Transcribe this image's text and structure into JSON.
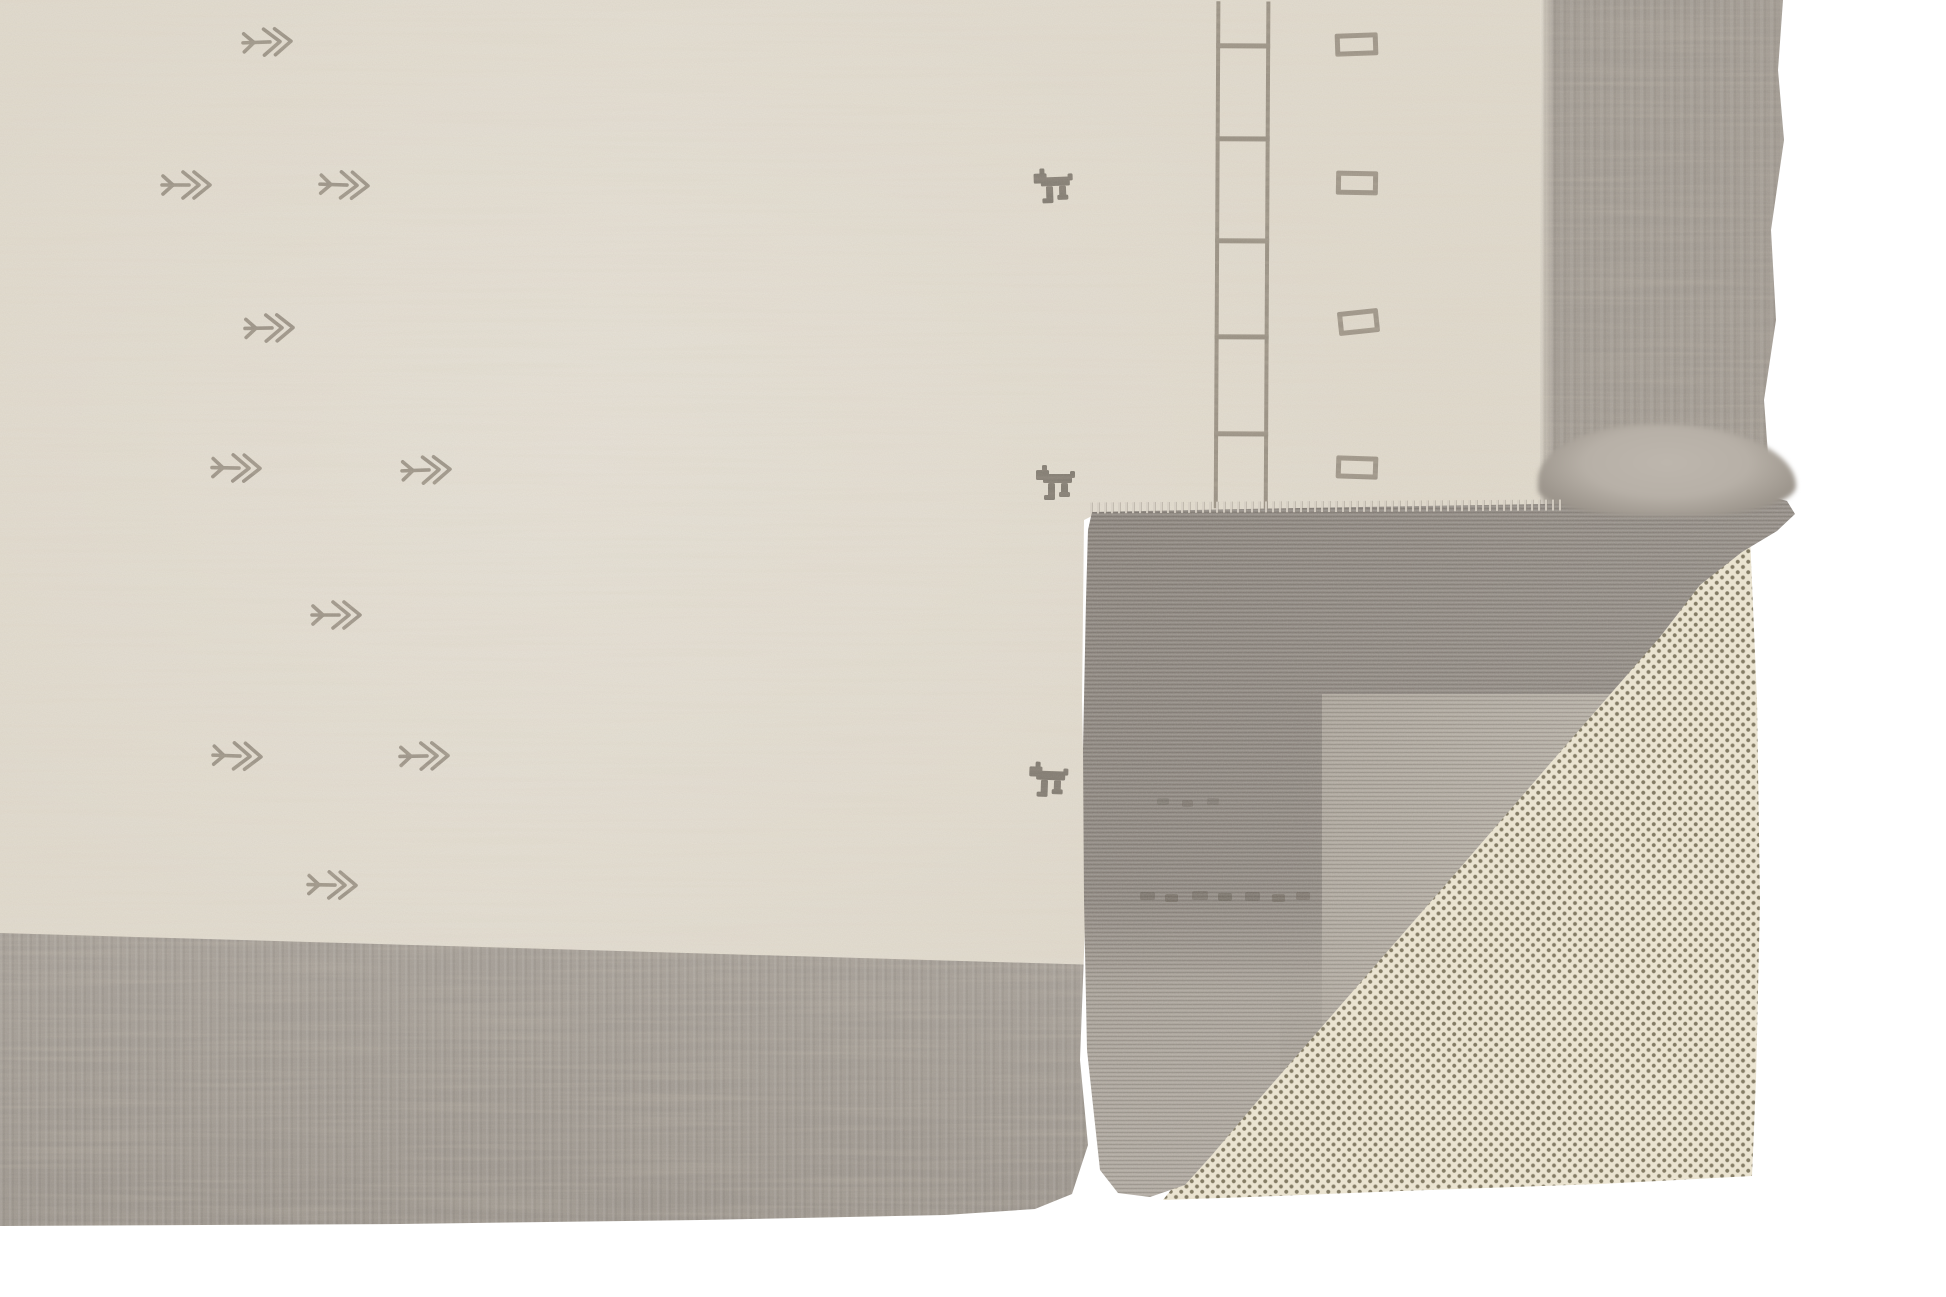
{
  "scene": {
    "description": "Product photograph of a hand-loomed wool area rug shown on a white background. The rug has an ivory field with sparse woven tribal motifs and a mottled gray border along its bottom and right sides. The bottom-right corner is folded over, revealing the gray ribbed back of the rug resting on a cream non-slip rug pad perforated with a grid of small dots.",
    "background": "plain white"
  },
  "colors": {
    "bg": "#ffffff",
    "field": "#e2dcd0",
    "borderFront": "#a29b93",
    "backDark": "#8c857e",
    "backMid": "#a39c93",
    "backLight": "#b6aea3",
    "pad": "#ece5d2",
    "padDot": "#837b64",
    "motif": "#857c6f",
    "motifDark": "#574f44",
    "animal": "#6b645b",
    "roll": "#b7b0a7",
    "fringe": "#d6cfc4"
  },
  "motifs": {
    "arrows": [
      {
        "x": 268,
        "y": 42,
        "rot": -2
      },
      {
        "x": 187,
        "y": 185,
        "rot": 0
      },
      {
        "x": 345,
        "y": 185,
        "rot": 2
      },
      {
        "x": 270,
        "y": 328,
        "rot": -1
      },
      {
        "x": 237,
        "y": 468,
        "rot": 1
      },
      {
        "x": 427,
        "y": 470,
        "rot": -2
      },
      {
        "x": 337,
        "y": 615,
        "rot": 0
      },
      {
        "x": 238,
        "y": 756,
        "rot": 2
      },
      {
        "x": 425,
        "y": 756,
        "rot": -1
      },
      {
        "x": 333,
        "y": 885,
        "rot": 1
      }
    ],
    "animals": [
      {
        "x": 1055,
        "y": 188,
        "rot": -2
      },
      {
        "x": 1057,
        "y": 485,
        "rot": 0
      },
      {
        "x": 1050,
        "y": 782,
        "rot": 2
      }
    ],
    "ladder": {
      "rails_x": [
        1213,
        1263
      ],
      "rail_width": 4,
      "y_top": 0,
      "y_bottom": 507,
      "rung_ys": [
        42,
        135,
        237,
        333,
        430
      ],
      "rung_height": 5,
      "tilt_deg": 0.3
    },
    "rectangles": [
      {
        "x": 1335,
        "y": 33,
        "w": 43,
        "h": 23,
        "rot": -2
      },
      {
        "x": 1336,
        "y": 171,
        "w": 42,
        "h": 24,
        "rot": 1
      },
      {
        "x": 1338,
        "y": 310,
        "w": 41,
        "h": 24,
        "rot": -6
      },
      {
        "x": 1336,
        "y": 456,
        "w": 42,
        "h": 23,
        "rot": 2
      }
    ],
    "back_marks": [
      {
        "x": 1140,
        "y": 892,
        "w": 15,
        "h": 8,
        "opacity": 0.3
      },
      {
        "x": 1165,
        "y": 894,
        "w": 13,
        "h": 8,
        "opacity": 0.34
      },
      {
        "x": 1192,
        "y": 891,
        "w": 16,
        "h": 9,
        "opacity": 0.28
      },
      {
        "x": 1218,
        "y": 893,
        "w": 14,
        "h": 8,
        "opacity": 0.36
      },
      {
        "x": 1245,
        "y": 892,
        "w": 15,
        "h": 9,
        "opacity": 0.3
      },
      {
        "x": 1272,
        "y": 894,
        "w": 13,
        "h": 8,
        "opacity": 0.33
      },
      {
        "x": 1296,
        "y": 892,
        "w": 14,
        "h": 8,
        "opacity": 0.27
      },
      {
        "x": 1157,
        "y": 798,
        "w": 12,
        "h": 7,
        "opacity": 0.2
      },
      {
        "x": 1182,
        "y": 800,
        "w": 11,
        "h": 7,
        "opacity": 0.22
      },
      {
        "x": 1207,
        "y": 798,
        "w": 12,
        "h": 7,
        "opacity": 0.19
      }
    ]
  }
}
